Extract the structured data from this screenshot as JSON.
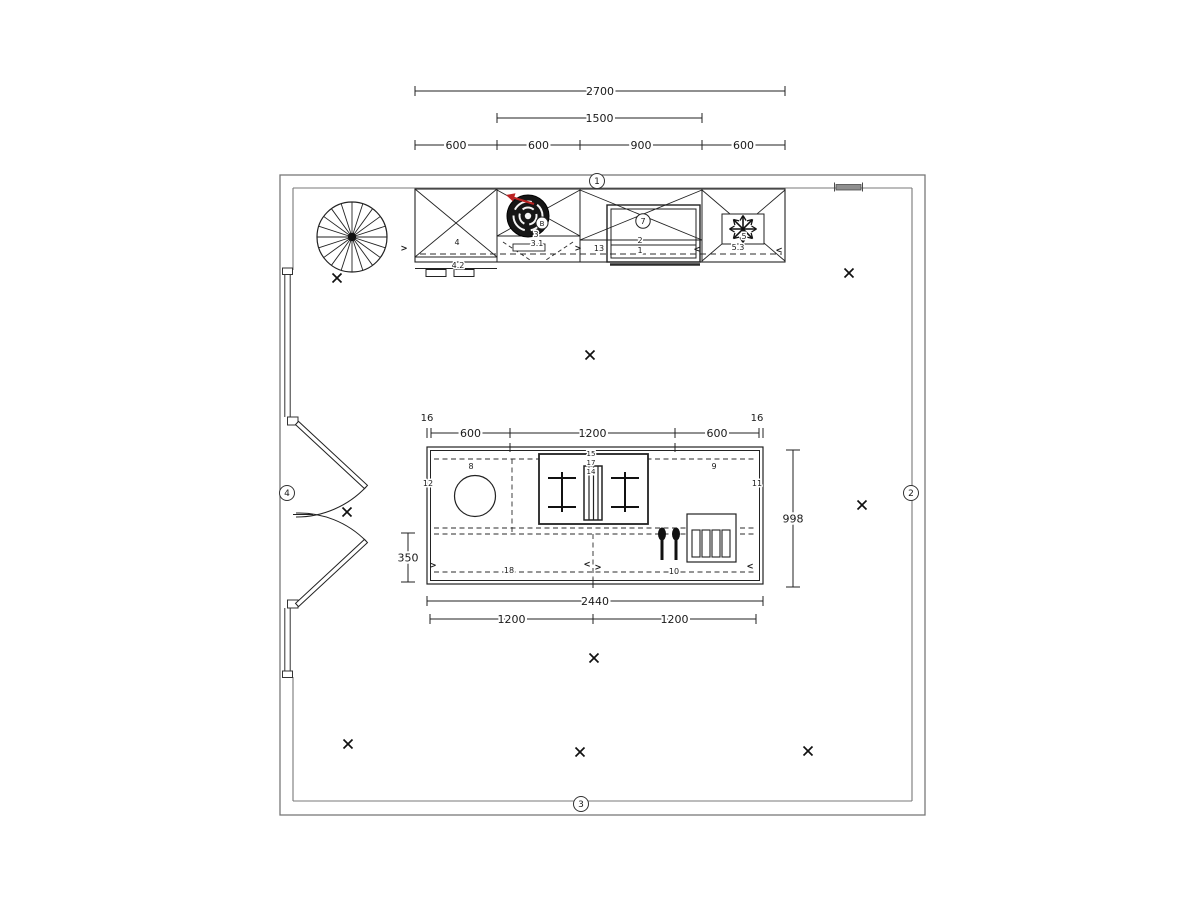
{
  "title": "kitchen-floor-plan-cad-drawing",
  "colors": {
    "wall": "#787878",
    "line": "#1f1f1f",
    "dash": "#2b2b2b",
    "red_arrow": "#bb2222",
    "gray_fill": "#8f8f8f",
    "background": "#ffffff"
  },
  "wall_markers": [
    {
      "label": "1",
      "x": 597,
      "y": 181
    },
    {
      "label": "2",
      "x": 911,
      "y": 493
    },
    {
      "label": "3",
      "x": 581,
      "y": 804
    },
    {
      "label": "4",
      "x": 287,
      "y": 493
    }
  ],
  "dims_top": [
    {
      "label": "2700",
      "x1": 415,
      "x2": 785,
      "y": 91
    },
    {
      "label": "1500",
      "x1": 497,
      "x2": 702,
      "y": 118
    },
    {
      "label": "600",
      "x1": 415,
      "x2": 497,
      "y": 145
    },
    {
      "label": "600",
      "x1": 497,
      "x2": 580,
      "y": 145
    },
    {
      "label": "900",
      "x1": 580,
      "x2": 702,
      "y": 145
    },
    {
      "label": "600",
      "x1": 702,
      "x2": 785,
      "y": 145
    }
  ],
  "dims_island_top": [
    {
      "label": "600",
      "x1": 431,
      "x2": 510,
      "y": 433
    },
    {
      "label": "1200",
      "x1": 510,
      "x2": 675,
      "y": 433
    },
    {
      "label": "600",
      "x1": 675,
      "x2": 759,
      "y": 433
    }
  ],
  "overhang_labels": [
    {
      "label": "16",
      "x": 427,
      "y": 421
    },
    {
      "label": "16",
      "x": 757,
      "y": 421
    }
  ],
  "dims_island_bottom": [
    {
      "label": "2440",
      "x1": 427,
      "x2": 763,
      "y": 601
    },
    {
      "label": "1200",
      "x1": 430,
      "x2": 593,
      "y": 619
    },
    {
      "label": "1200",
      "x1": 593,
      "x2": 756,
      "y": 619
    }
  ],
  "dims_vertical": [
    {
      "label": "998",
      "x": 793,
      "y1": 450,
      "y2": 587
    },
    {
      "label": "350",
      "x": 408,
      "y1": 533,
      "y2": 582
    }
  ],
  "part_labels": [
    {
      "label": "4",
      "x": 457,
      "y": 245,
      "size": 8
    },
    {
      "label": "4.2",
      "x": 458,
      "y": 268,
      "size": 8
    },
    {
      "label": "B",
      "x": 542,
      "y": 226,
      "size": 7
    },
    {
      "label": "3",
      "x": 536,
      "y": 237,
      "size": 8
    },
    {
      "label": "3.1",
      "x": 537,
      "y": 246,
      "size": 8
    },
    {
      "label": "13",
      "x": 599,
      "y": 251,
      "size": 8
    },
    {
      "label": "7",
      "x": 643,
      "y": 224,
      "size": 8,
      "circled": true
    },
    {
      "label": "2",
      "x": 640,
      "y": 243,
      "size": 8
    },
    {
      "label": "1",
      "x": 640,
      "y": 253,
      "size": 8
    },
    {
      "label": "5",
      "x": 744,
      "y": 239,
      "size": 8
    },
    {
      "label": "5.3",
      "x": 738,
      "y": 250,
      "size": 8
    },
    {
      "label": "8",
      "x": 471,
      "y": 469,
      "size": 8
    },
    {
      "label": "12",
      "x": 428,
      "y": 486,
      "size": 8
    },
    {
      "label": "15",
      "x": 591,
      "y": 456,
      "size": 7
    },
    {
      "label": "17",
      "x": 591,
      "y": 465,
      "size": 7
    },
    {
      "label": "14",
      "x": 591,
      "y": 474,
      "size": 7
    },
    {
      "label": "9",
      "x": 714,
      "y": 469,
      "size": 8
    },
    {
      "label": "11",
      "x": 757,
      "y": 486,
      "size": 8
    },
    {
      "label": "18",
      "x": 509,
      "y": 573,
      "size": 8
    },
    {
      "label": "10",
      "x": 674,
      "y": 574,
      "size": 8
    }
  ],
  "swing_arrows": [
    {
      "glyph": ">",
      "x": 404,
      "y": 251
    },
    {
      "glyph": ">",
      "x": 578,
      "y": 251
    },
    {
      "glyph": "<",
      "x": 697,
      "y": 252
    },
    {
      "glyph": "<",
      "x": 779,
      "y": 253
    },
    {
      "glyph": ">",
      "x": 433,
      "y": 568
    },
    {
      "glyph": "<",
      "x": 587,
      "y": 567
    },
    {
      "glyph": ">",
      "x": 598,
      "y": 570
    },
    {
      "glyph": "<",
      "x": 750,
      "y": 569
    }
  ],
  "x_marks": [
    {
      "x": 337,
      "y": 278
    },
    {
      "x": 849,
      "y": 273
    },
    {
      "x": 590,
      "y": 355
    },
    {
      "x": 347,
      "y": 512
    },
    {
      "x": 862,
      "y": 505
    },
    {
      "x": 594,
      "y": 658
    },
    {
      "x": 348,
      "y": 744
    },
    {
      "x": 580,
      "y": 752
    },
    {
      "x": 808,
      "y": 751
    }
  ],
  "fixtures": [
    {
      "name": "spiral-staircase-icon"
    },
    {
      "name": "double-door-icon"
    },
    {
      "name": "boiler-icon"
    },
    {
      "name": "oven-icon"
    },
    {
      "name": "freezer-snowflake-icon"
    },
    {
      "name": "sink-icon"
    },
    {
      "name": "gas-burner-icon"
    },
    {
      "name": "grill-icon"
    },
    {
      "name": "cutlery-icon"
    },
    {
      "name": "plate-rack-icon"
    },
    {
      "name": "x-position-marker"
    }
  ]
}
